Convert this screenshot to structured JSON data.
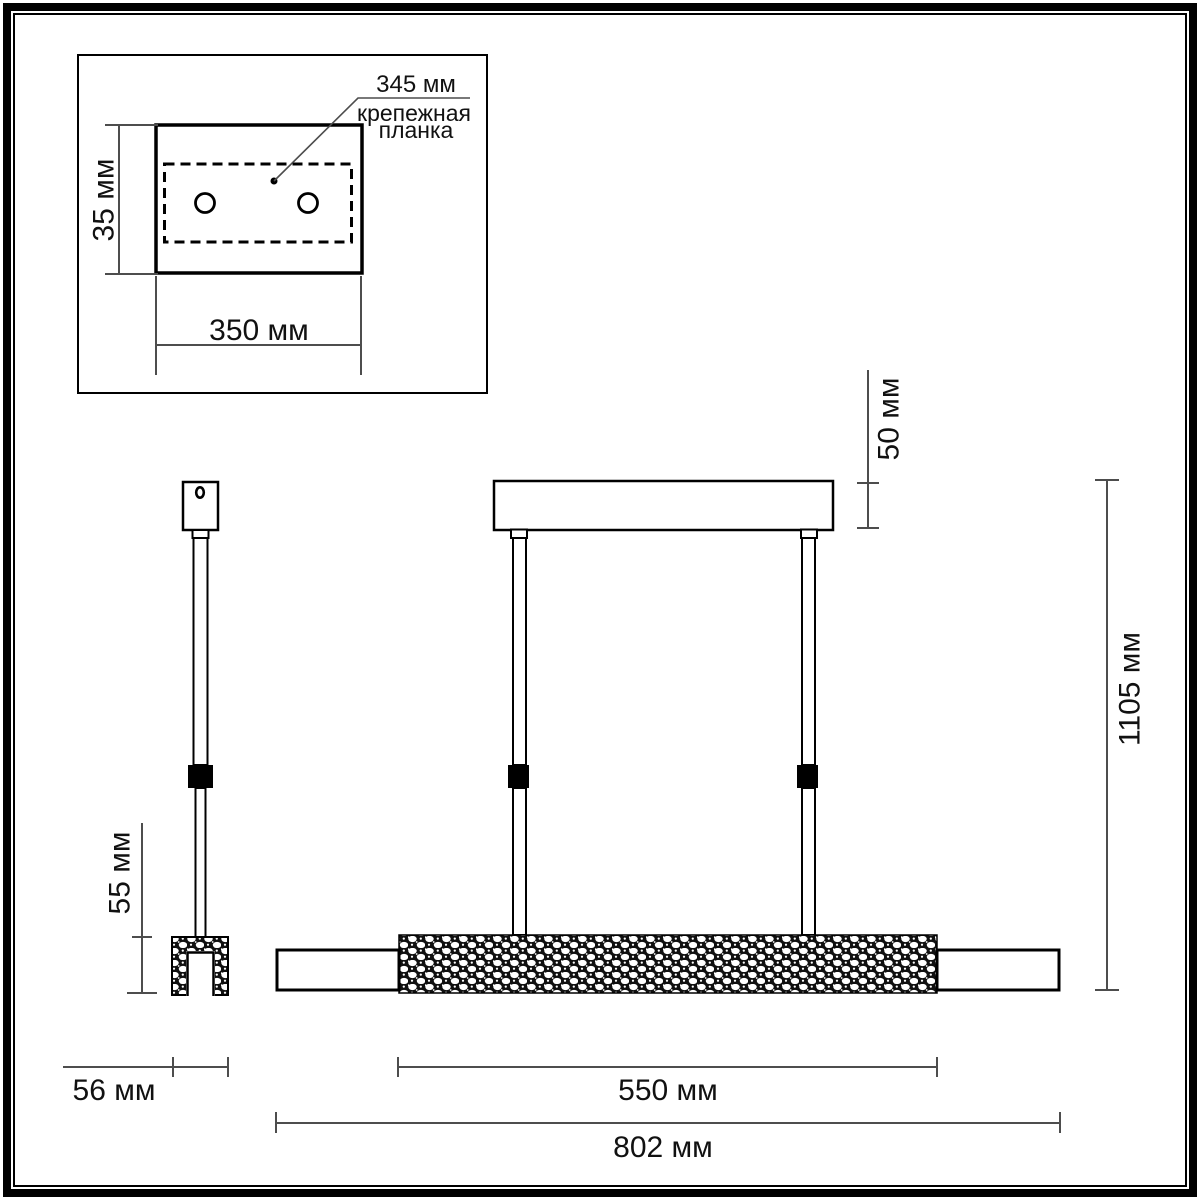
{
  "drawing": {
    "kind": "pendant-light-dimension-drawing",
    "inset_detail": {
      "callout_value": "345 мм",
      "callout_caption_line1": "крепежная",
      "callout_caption_line2": "планка",
      "plate_height_label": "35 мм",
      "plate_width_label": "350 мм"
    },
    "side_view": {
      "bar_height_label": "55 мм",
      "bar_width_label": "56 мм"
    },
    "front_view": {
      "canopy_height_label": "50 мм",
      "overall_height_label": "1105 мм",
      "lit_section_width_label": "550 мм",
      "overall_width_label": "802 мм"
    },
    "colors": {
      "line": "#000000",
      "dimension_line": "#4d4d4d",
      "background": "#ffffff"
    }
  }
}
